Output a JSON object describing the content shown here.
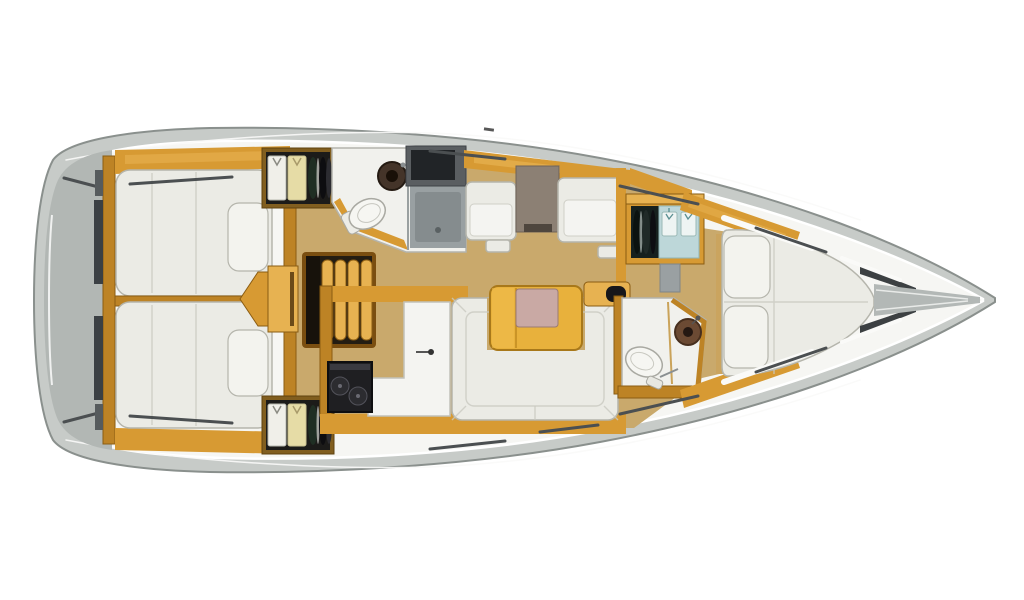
{
  "meta": {
    "description": "Top-down interior floor plan of a sailing yacht, bow pointing right, no text labels visible",
    "view": "top-down",
    "bow_direction": "right"
  },
  "colors": {
    "background": "#ffffff",
    "hull_deck": "#c7cbc8",
    "hull_deck_dark": "#b2b7b4",
    "hull_outline": "#8a908d",
    "hull_inner": "#f6f6f3",
    "wood": "#d79a33",
    "wood_dark": "#bd8325",
    "wood_light": "#e7b251",
    "wood_frame": "#8a5c12",
    "floor": "#c9a96c",
    "floor_light": "#d8bc84",
    "mattress": "#ebebe5",
    "pillow": "#f3f3ee",
    "mattress_edge": "#b5b5ac",
    "seam": "#c9c9c1",
    "room_white": "#f1f1ed",
    "partition": "#b4b4ad",
    "dark_fixture": "#232326",
    "shower": "#99a0a2",
    "shower_dark": "#858c8e",
    "chart_table": "#8c8074",
    "table_top": "#e8b13c",
    "table_inset": "#c9a9a4",
    "sink_brown": "#6b4a33",
    "sink_dark": "#443429",
    "locker_blue": "#bdd7d9",
    "shirt_white": "#f0efe9",
    "shirt_yellow": "#e6dca6",
    "rail_dark": "#4b4f51",
    "deck_dash_white": "#fafaf8",
    "porcelain": "#f6f6f2"
  },
  "boat": {
    "areas": [
      {
        "name": "stern-platform",
        "fixtures": [
          "transom",
          "stern-rails"
        ]
      },
      {
        "name": "aft-cabin-port",
        "fixtures": [
          "double-berth",
          "pillow",
          "hanging-locker-with-clothes"
        ]
      },
      {
        "name": "aft-cabin-starboard",
        "fixtures": [
          "double-berth",
          "pillow",
          "hanging-locker-with-clothes"
        ]
      },
      {
        "name": "companionway",
        "fixtures": [
          "steps",
          "engine-box"
        ]
      },
      {
        "name": "head-port",
        "fixtures": [
          "toilet",
          "washbasin",
          "shower-stall",
          "storage-cabinet"
        ]
      },
      {
        "name": "nav-station",
        "fixtures": [
          "settee",
          "chart-table",
          "settee"
        ]
      },
      {
        "name": "galley",
        "fixtures": [
          "sink-counter",
          "faucet",
          "stove-with-two-burners",
          "fridge-lid"
        ]
      },
      {
        "name": "saloon",
        "fixtures": [
          "u-shaped-sofa",
          "folding-table",
          "sideboard"
        ]
      },
      {
        "name": "head-starboard",
        "fixtures": [
          "toilet",
          "washbasin"
        ]
      },
      {
        "name": "forward-cabin",
        "fixtures": [
          "v-berth",
          "pillow",
          "pillow",
          "wardrobe-with-hangers",
          "shelves"
        ]
      },
      {
        "name": "bow",
        "fixtures": [
          "anchor-locker"
        ]
      }
    ]
  }
}
